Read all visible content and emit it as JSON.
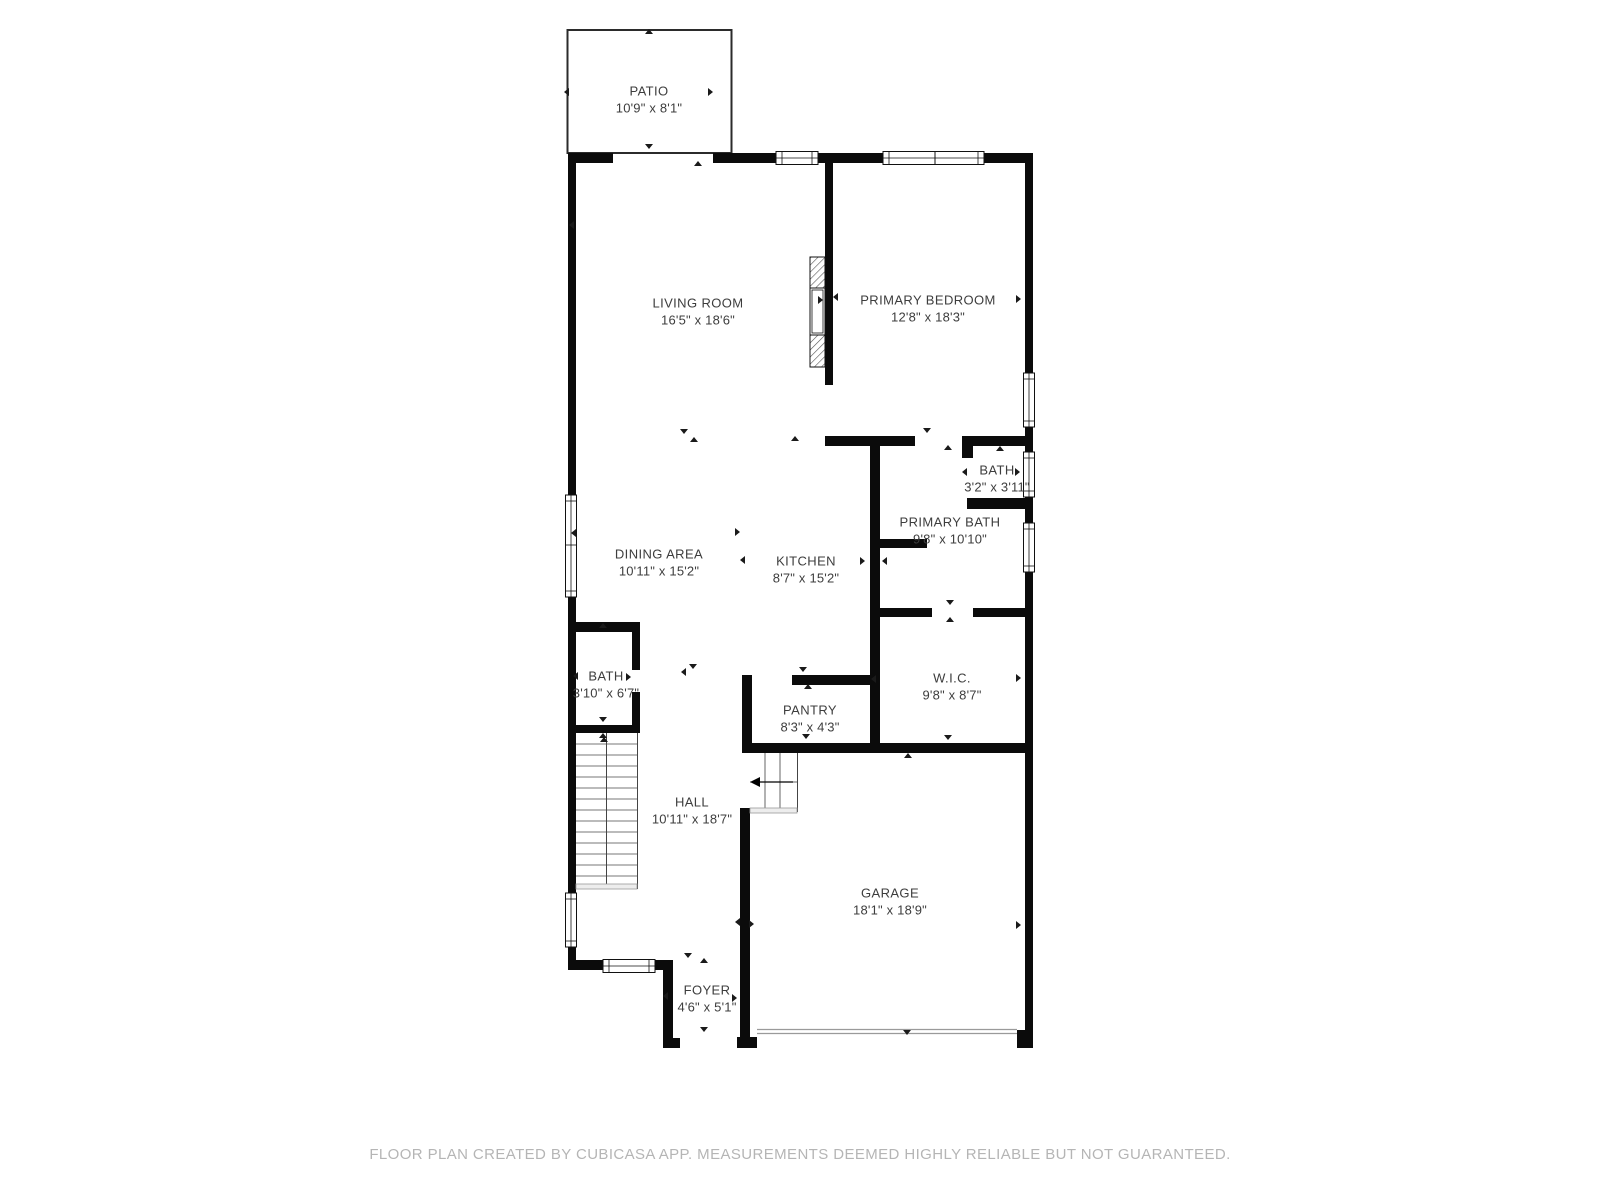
{
  "footer": {
    "text": "FLOOR PLAN CREATED BY CUBICASA APP. MEASUREMENTS DEEMED HIGHLY RELIABLE BUT NOT GUARANTEED."
  },
  "floorplan": {
    "rooms": [
      {
        "id": "patio",
        "name": "PATIO",
        "dims": "10'9\" x 8'1\"",
        "x": 649,
        "y": 91
      },
      {
        "id": "living-room",
        "name": "LIVING ROOM",
        "dims": "16'5\" x 18'6\"",
        "x": 698,
        "y": 303
      },
      {
        "id": "primary-bedroom",
        "name": "PRIMARY BEDROOM",
        "dims": "12'8\" x 18'3\"",
        "x": 928,
        "y": 300
      },
      {
        "id": "bath",
        "name": "BATH",
        "dims": "3'2\" x 3'11\"",
        "x": 997,
        "y": 470
      },
      {
        "id": "primary-bath",
        "name": "PRIMARY BATH",
        "dims": "9'8\" x 10'10\"",
        "x": 950,
        "y": 522
      },
      {
        "id": "dining-area",
        "name": "DINING AREA",
        "dims": "10'11\" x 15'2\"",
        "x": 659,
        "y": 554
      },
      {
        "id": "kitchen",
        "name": "KITCHEN",
        "dims": "8'7\" x 15'2\"",
        "x": 806,
        "y": 561
      },
      {
        "id": "hall-bath",
        "name": "BATH",
        "dims": "3'10\" x 6'7\"",
        "x": 606,
        "y": 676
      },
      {
        "id": "wic",
        "name": "W.I.C.",
        "dims": "9'8\" x 8'7\"",
        "x": 952,
        "y": 678
      },
      {
        "id": "pantry",
        "name": "PANTRY",
        "dims": "8'3\" x 4'3\"",
        "x": 810,
        "y": 710
      },
      {
        "id": "hall",
        "name": "HALL",
        "dims": "10'11\" x 18'7\"",
        "x": 692,
        "y": 802
      },
      {
        "id": "garage",
        "name": "GARAGE",
        "dims": "18'1\" x 18'9\"",
        "x": 890,
        "y": 893
      },
      {
        "id": "foyer",
        "name": "FOYER",
        "dims": "4'6\" x 5'1\"",
        "x": 707,
        "y": 990
      }
    ],
    "markers": [
      {
        "x": 649,
        "y": 33,
        "dir": "up"
      },
      {
        "x": 568,
        "y": 92,
        "dir": "left"
      },
      {
        "x": 712,
        "y": 92,
        "dir": "right"
      },
      {
        "x": 649,
        "y": 148,
        "dir": "down"
      },
      {
        "x": 698,
        "y": 165,
        "dir": "up"
      },
      {
        "x": 573,
        "y": 225,
        "dir": "left"
      },
      {
        "x": 822,
        "y": 300,
        "dir": "right"
      },
      {
        "x": 837,
        "y": 297,
        "dir": "left"
      },
      {
        "x": 1020,
        "y": 299,
        "dir": "right"
      },
      {
        "x": 575,
        "y": 533,
        "dir": "left"
      },
      {
        "x": 684,
        "y": 433,
        "dir": "down"
      },
      {
        "x": 694,
        "y": 441,
        "dir": "up"
      },
      {
        "x": 795,
        "y": 440,
        "dir": "up"
      },
      {
        "x": 927,
        "y": 432,
        "dir": "down"
      },
      {
        "x": 948,
        "y": 449,
        "dir": "up"
      },
      {
        "x": 1000,
        "y": 450,
        "dir": "up"
      },
      {
        "x": 966,
        "y": 472,
        "dir": "left"
      },
      {
        "x": 1019,
        "y": 472,
        "dir": "right"
      },
      {
        "x": 864,
        "y": 561,
        "dir": "right"
      },
      {
        "x": 886,
        "y": 561,
        "dir": "left"
      },
      {
        "x": 739,
        "y": 532,
        "dir": "right"
      },
      {
        "x": 744,
        "y": 560,
        "dir": "left"
      },
      {
        "x": 950,
        "y": 604,
        "dir": "down"
      },
      {
        "x": 950,
        "y": 621,
        "dir": "up"
      },
      {
        "x": 1020,
        "y": 678,
        "dir": "right"
      },
      {
        "x": 875,
        "y": 679,
        "dir": "left"
      },
      {
        "x": 948,
        "y": 739,
        "dir": "down"
      },
      {
        "x": 908,
        "y": 757,
        "dir": "up"
      },
      {
        "x": 803,
        "y": 671,
        "dir": "down"
      },
      {
        "x": 808,
        "y": 688,
        "dir": "up"
      },
      {
        "x": 806,
        "y": 738,
        "dir": "down"
      },
      {
        "x": 603,
        "y": 627,
        "dir": "up"
      },
      {
        "x": 577,
        "y": 676,
        "dir": "left"
      },
      {
        "x": 630,
        "y": 677,
        "dir": "right"
      },
      {
        "x": 603,
        "y": 721,
        "dir": "down"
      },
      {
        "x": 603,
        "y": 737,
        "dir": "up"
      },
      {
        "x": 604,
        "y": 741,
        "dir": "up"
      },
      {
        "x": 685,
        "y": 672,
        "dir": "left"
      },
      {
        "x": 693,
        "y": 668,
        "dir": "down"
      },
      {
        "x": 739,
        "y": 922,
        "dir": "left"
      },
      {
        "x": 753,
        "y": 924,
        "dir": "right"
      },
      {
        "x": 1020,
        "y": 925,
        "dir": "right"
      },
      {
        "x": 907,
        "y": 1034,
        "dir": "down"
      },
      {
        "x": 688,
        "y": 957,
        "dir": "down"
      },
      {
        "x": 704,
        "y": 962,
        "dir": "up"
      },
      {
        "x": 667,
        "y": 996,
        "dir": "left"
      },
      {
        "x": 736,
        "y": 998,
        "dir": "right"
      },
      {
        "x": 704,
        "y": 1031,
        "dir": "down"
      }
    ]
  }
}
